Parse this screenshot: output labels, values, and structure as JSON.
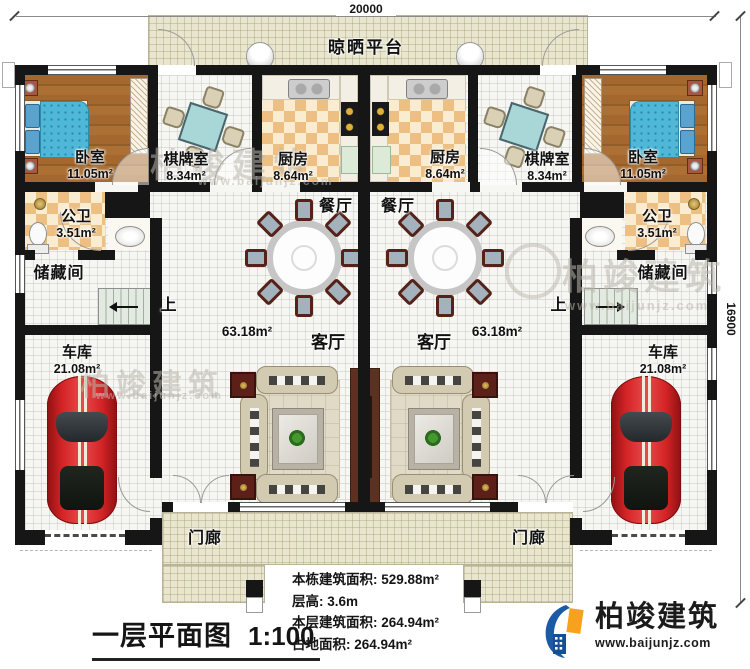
{
  "dimensions": {
    "top": "20000",
    "right": "16900"
  },
  "platform_label": "晾晒平台",
  "rooms": {
    "bedroom_left": {
      "name": "卧室",
      "area": "11.05m²"
    },
    "mahjong_left": {
      "name": "棋牌室",
      "area": "8.34m²"
    },
    "kitchen_left": {
      "name": "厨房",
      "area": "8.64m²"
    },
    "kitchen_right": {
      "name": "厨房",
      "area": "8.64m²"
    },
    "mahjong_right": {
      "name": "棋牌室",
      "area": "8.34m²"
    },
    "bedroom_right": {
      "name": "卧室",
      "area": "11.05m²"
    },
    "bath_left": {
      "name": "公卫",
      "area": "3.51m²"
    },
    "bath_right": {
      "name": "公卫",
      "area": "3.51m²"
    },
    "storage_left": {
      "name": "储藏间"
    },
    "storage_right": {
      "name": "储藏间"
    },
    "garage_left": {
      "name": "车库",
      "area": "21.08m²"
    },
    "garage_right": {
      "name": "车库",
      "area": "21.08m²"
    },
    "dining_left": {
      "name": "餐厅"
    },
    "dining_right": {
      "name": "餐厅"
    },
    "living_left": {
      "name": "客厅",
      "area": "63.18m²"
    },
    "living_right": {
      "name": "客厅",
      "area": "63.18m²"
    },
    "porch_left": {
      "name": "门廊"
    },
    "porch_right": {
      "name": "门廊"
    },
    "stairs_left": {
      "label": "上"
    },
    "stairs_right": {
      "label": "上"
    }
  },
  "stats": {
    "building_total": "本栋建筑面积: 529.88m²",
    "floor_height": "层高: 3.6m",
    "floor_area": "本层建筑面积: 264.94m²",
    "footprint": "占地面积: 264.94m²"
  },
  "title": {
    "text": "一层平面图",
    "scale": "1:100"
  },
  "brand": {
    "name": "柏竣建筑",
    "website": "www.baijunjz.com"
  },
  "watermark": {
    "text": "柏竣建筑",
    "website": "www.baijunjz.com"
  },
  "colors": {
    "wall": "#161616",
    "platform": "#e9e6cf",
    "checker_dark": "#edbf82",
    "checker_light": "#f9ecd1",
    "wood": "#a4682e",
    "bed": "#4fb8d8",
    "car": "#d42426",
    "brand_blue": "#1b5aa5",
    "brand_orange": "#f6a21c"
  }
}
